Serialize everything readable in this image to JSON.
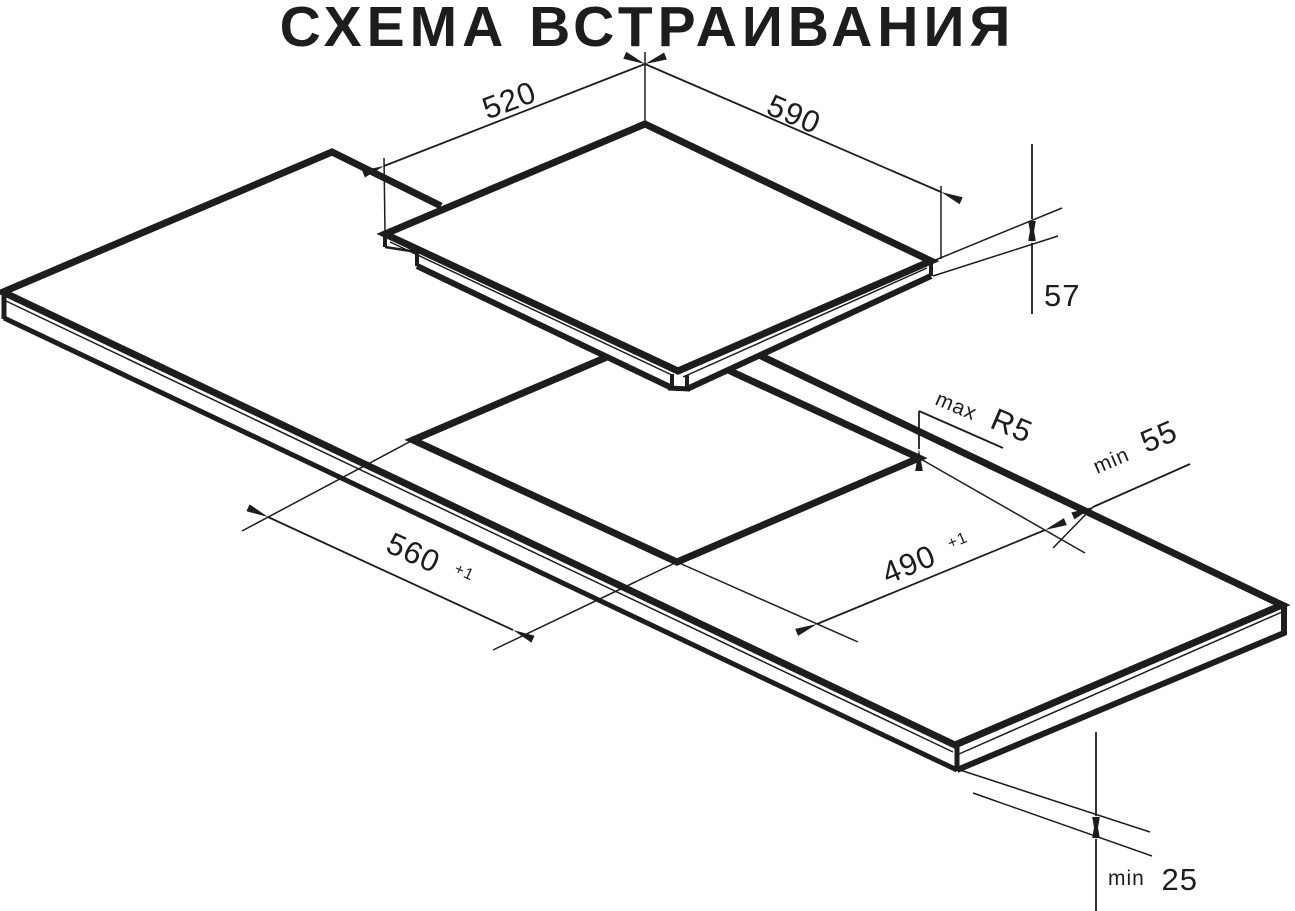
{
  "title": "СХЕМА ВСТРАИВАНИЯ",
  "colors": {
    "ink": "#1d1d1b",
    "background": "#ffffff"
  },
  "dimensions": {
    "hob_top_depth": {
      "value": "520"
    },
    "hob_top_width": {
      "value": "590"
    },
    "hob_height": {
      "value": "57"
    },
    "cutout_corner_radius": {
      "prefix": "max",
      "value": "R5"
    },
    "cutout_edge_clearance": {
      "prefix": "min",
      "value": "55"
    },
    "cutout_length": {
      "value": "560",
      "tolerance": "+1"
    },
    "cutout_depth": {
      "value": "490",
      "tolerance": "+1"
    },
    "worktop_thickness": {
      "prefix": "min",
      "value": "25"
    }
  }
}
